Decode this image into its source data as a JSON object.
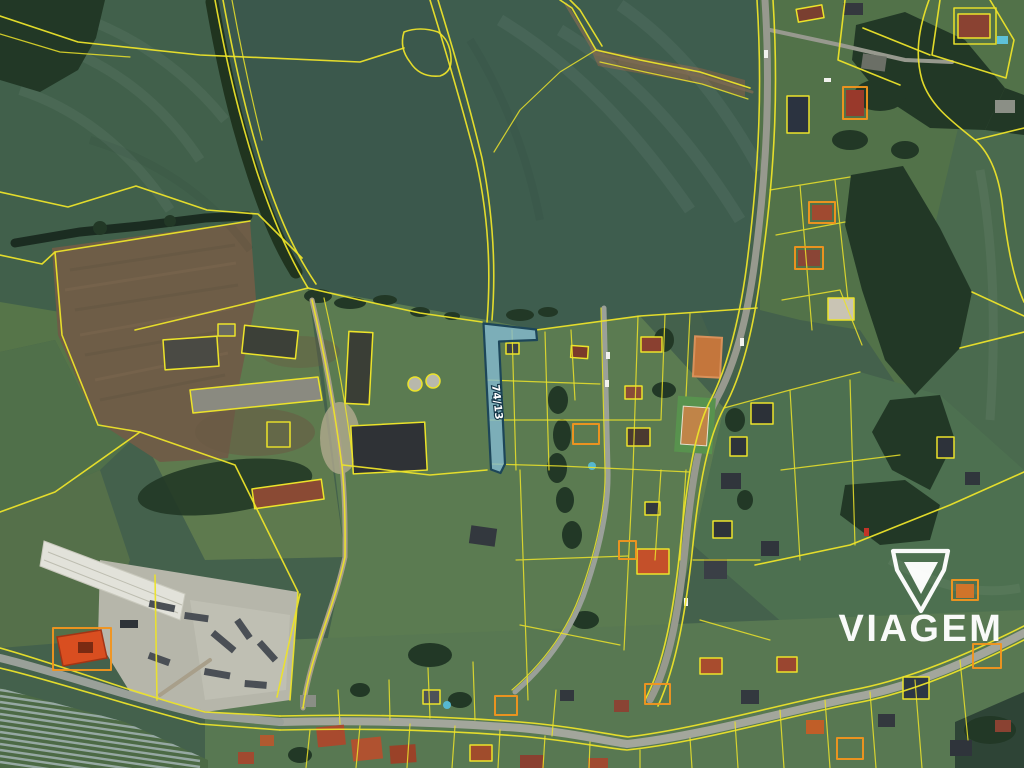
{
  "highlighted_parcel": {
    "label": "74/13",
    "fill": "#84bcd2",
    "border": "#1d4659"
  },
  "watermark": {
    "text": "VIAGEM",
    "color": "#ffffff"
  },
  "overlay_colors": {
    "cadastre_line": "#ece32a",
    "building_highlight": "#f2951e",
    "road": "#97998e"
  }
}
